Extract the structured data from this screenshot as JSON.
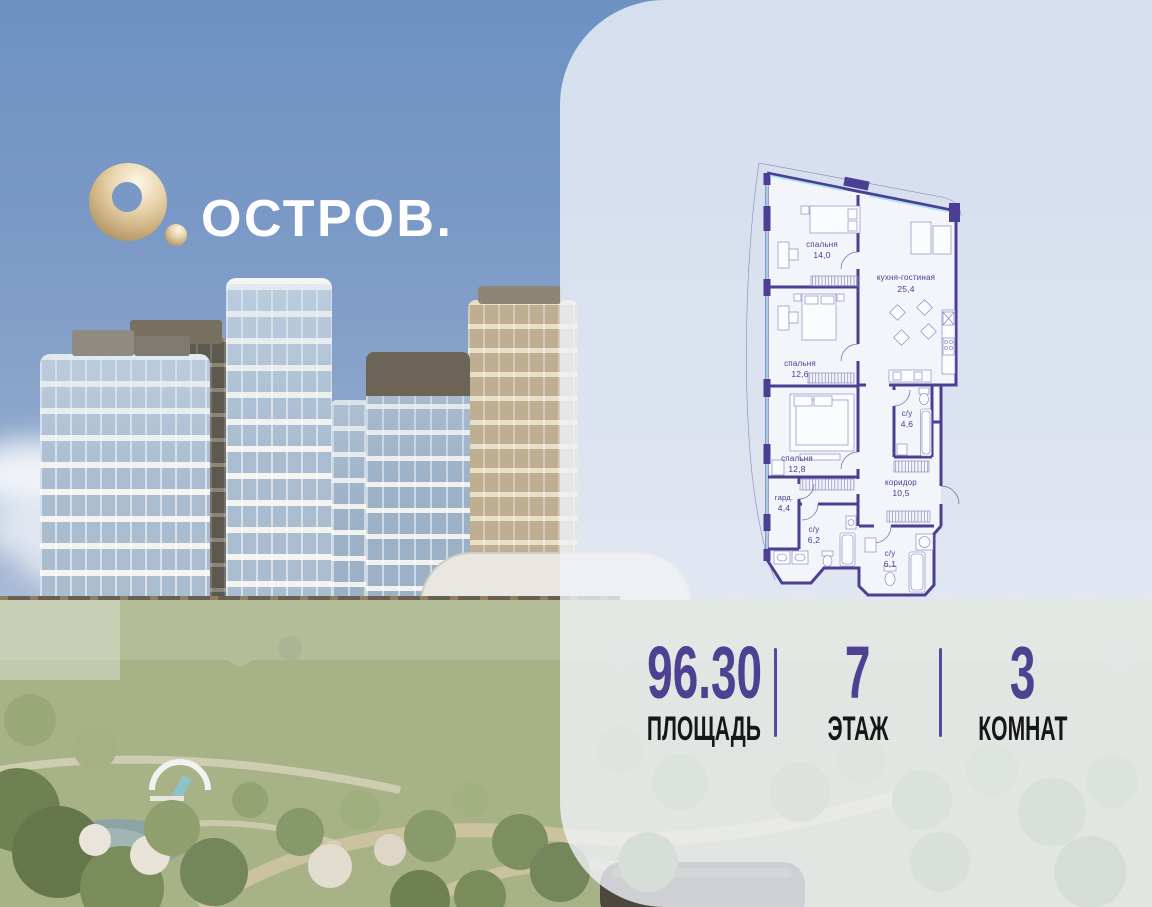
{
  "logo": {
    "brand": "ОСТРОВ."
  },
  "floorplan": {
    "rooms": [
      {
        "name": "спальня",
        "area": "14,0"
      },
      {
        "name": "кухня-гостиная",
        "area": "25,4"
      },
      {
        "name": "спальня",
        "area": "12,6"
      },
      {
        "name": "с/у",
        "area": "4,6"
      },
      {
        "name": "спальня",
        "area": "12,8"
      },
      {
        "name": "коридор",
        "area": "10,5"
      },
      {
        "name": "гард.",
        "area": "4,4"
      },
      {
        "name": "с/у",
        "area": "6,2"
      },
      {
        "name": "с/у",
        "area": "6,1"
      }
    ]
  },
  "stats": {
    "items": [
      {
        "value": "96.30",
        "label": "ПЛОЩАДЬ"
      },
      {
        "value": "7",
        "label": "ЭТАЖ"
      },
      {
        "value": "3",
        "label": "КОМНАТ"
      }
    ]
  },
  "colors": {
    "accent_purple": "#4e4191",
    "plan_wall": "#4a3f92",
    "window_blue": "#aedff2",
    "logo_gold": "#d9bd92",
    "panel_bg": "#eef1f7"
  }
}
